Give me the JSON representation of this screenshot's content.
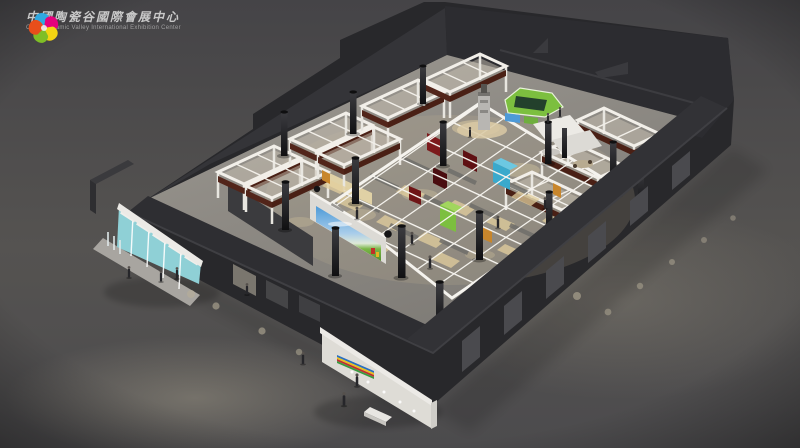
{
  "logo": {
    "chinese_title": "中國陶瓷谷國際會展中心",
    "english_title": "China Ceramic Valley International Exhibition Center"
  },
  "scene": {
    "subject": "aerial cutaway 3D rendering of exhibition hall interior with booth grid",
    "palette": {
      "backdrop": "#504f51",
      "building_shell": "#28282b",
      "parapet_light": "#343438",
      "interior_floor": "#93908a",
      "booth_white": "#f2efe9",
      "booth_sign_brown": "#52251a",
      "partition_gray": "#6f6e6a",
      "accent_red": "#7c1a1c",
      "accent_dark_red": "#4a0d10",
      "accent_cyan": "#3aa9cc",
      "accent_green": "#7cbf3f",
      "accent_orange": "#c8862c",
      "billboard_frame": "#dcdad5",
      "billboard_sky": "#4d9ad8",
      "entrance_teal": "#8fd0d6",
      "louver_white": "#dedcd6",
      "spotlight_warm": "#d8c8a0",
      "figure_dark": "#26262a",
      "logo_swirl": [
        "#2fa8e1",
        "#e5007d",
        "#f3d512",
        "#7fbe26",
        "#e94e1b"
      ]
    }
  }
}
